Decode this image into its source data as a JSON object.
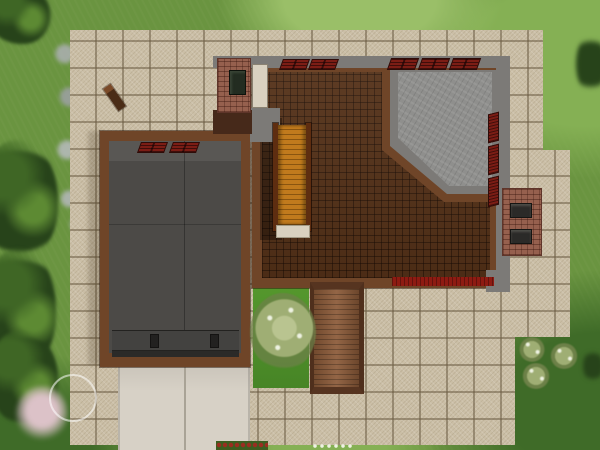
{
  "scene": {
    "view": "top-down lot view of a house under construction",
    "environment": {
      "terrain": "grass lawn",
      "rock_path": "blurred gray stone path along left edge",
      "vegetation": {
        "tree_corner_top_left": "dark tree canopy top-left corner",
        "tree_clusters_left": 3,
        "pink_flower_bush_bottom_left": "pale pink flowering bush",
        "courtyard_flowering_tree": "white-blossom tree in grass courtyard",
        "white_flower_shrubs_bottom_right": 3,
        "dark_shrubs_right_edge": 2,
        "red_flower_bed": "red flowers below patio",
        "white_flower_patch": "white flowers below patio"
      }
    },
    "hardscape": {
      "tile_patio": "sandstone tile patio surrounding the house",
      "driveway": "light concrete two-slab driveway at bottom-left",
      "wood_deck": "vertical wooden plank walkway on south side"
    },
    "house": {
      "garage_wing": {
        "roof": "flat dark gray roof with center seams",
        "garage_door": "garage door mechanism bar with two hinges",
        "window_count": 2
      },
      "main_wing": {
        "floor": "brown parquet wood floor",
        "stone_room": "gray slate-floor room in north-east corner with diagonal wall",
        "staircase": "orange wooden staircase with side rails and cream landing pad",
        "fireplace_chimney": "brick chimney with dark firebox at north-west corner",
        "exterior_chimney": "brick chimney with two vents on east wall",
        "interior_door": "cream door beside fireplace",
        "windows_top_count": 5,
        "windows_right_count": 3,
        "red_planter_strip": "red strip along south wall",
        "eaves": "gray roof eave bands on north and east sides"
      }
    },
    "ui": {
      "cursor": "translucent circular brush cursor ring at bottom-left",
      "dropped_object": "small wooden post lying diagonally on patio tiles"
    }
  },
  "colors": {
    "grass_base": "#6a9440",
    "grass_light": "#85b054",
    "grass_pale": "#9abf68",
    "grass_dark": "#3f6b28",
    "tree_dark": "#27431a",
    "tree_mid": "#3f6625",
    "tree_light": "#5d8a33",
    "rock_gray": "#a8aeab",
    "tile_base": "#cbbfa7",
    "driveway": "#d7d1c6",
    "driveway_line": "#a9a396",
    "deck_wood": "#8b5a38",
    "deck_dark": "#4f2f1c",
    "parquet": "#543118",
    "wall_brown": "#6f4528",
    "wall_dark": "#46291a",
    "eave_gray": "#7c7a77",
    "stone_floor": "#8f8f8d",
    "garage_roof": "#4c4a47",
    "garage_roof_light": "#595754",
    "garage_door": "#434240",
    "garage_door_dark": "#2b2a28",
    "brick": "#96604e",
    "brick_dark": "#5f352a",
    "window_red": "#7c1d15",
    "window_dark": "#2e0c08",
    "stair_orange": "#c17a1d",
    "stair_line": "#8a5510",
    "stair_rail": "#5e2d10",
    "landing_cream": "#d9d1c0",
    "red_strip": "#8e1b12",
    "firebox": "#232c21",
    "flower_pink": "#dcc2c8",
    "flower_red": "#9c2c20",
    "flower_white": "#eef2e2",
    "bush_sage": "#9fae74",
    "bush_sage_dark": "#6d8148",
    "cursor_ring": "rgba(255,255,255,0.55)"
  }
}
